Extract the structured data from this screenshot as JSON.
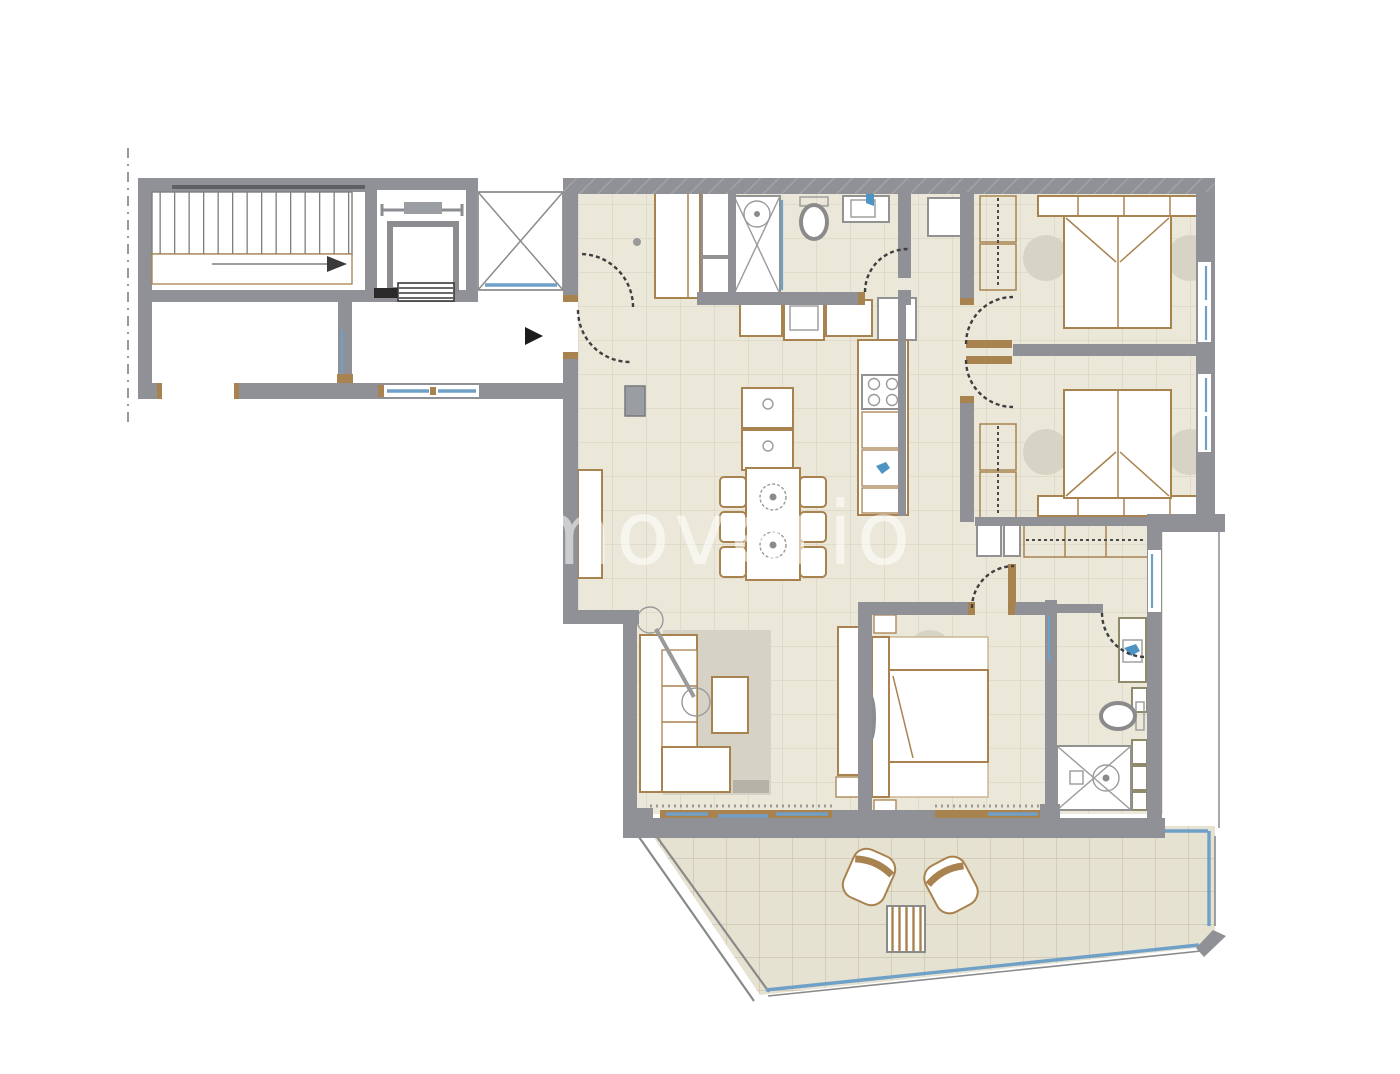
{
  "watermark": {
    "text": "immoverio"
  },
  "palette": {
    "wall": "#8f9196",
    "wall_hatch": "#a5a7ab",
    "floor": "#ebe8da",
    "floor_grid": "#d8d4c2",
    "terrace_floor": "#e6e2d1",
    "terrace_grid": "#cbc5b1",
    "furniture_outline": "#a8824f",
    "fixture_outline": "#929292",
    "window": "#6fa0c8",
    "door_arc": "#3f3f3f",
    "rug": "#d6d3c6",
    "shadow": "#d8d4c5",
    "boundary_dash": "#9a9a9a",
    "entrance_arrow": "#1c1c1c"
  },
  "symbols": [
    "staircase",
    "stair-direction-arrow",
    "elevator",
    "light-shaft-cross",
    "entrance-arrow",
    "entry-double-door-swings",
    "shower",
    "toilet",
    "washbasin",
    "washing-machine",
    "kitchen-counter",
    "cooktop",
    "kitchen-sink",
    "kitchen-island",
    "dining-table-six-chairs",
    "sideboard",
    "sofa",
    "coffee-table",
    "floor-lamp",
    "rug",
    "tv-panel",
    "double-bed",
    "wardrobe",
    "hallway-wardrobe",
    "ensuite-shower",
    "ensuite-toilet",
    "ensuite-washbasin",
    "terrace-lounge-chairs",
    "terrace-side-table",
    "window-glazing",
    "door-swing-arc",
    "property-boundary-dashed-line"
  ]
}
